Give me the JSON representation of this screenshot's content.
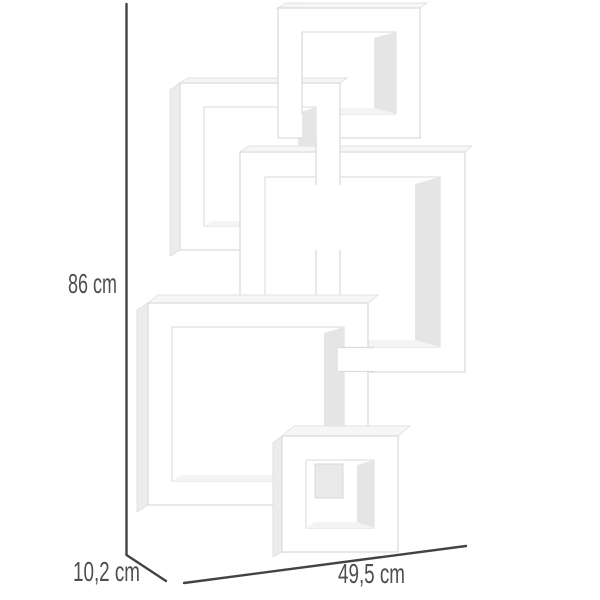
{
  "product_image": {
    "kind": "interlocking cube wall shelf, white, five cubes, diagonal arrangement",
    "cube_count": 5
  },
  "dimensions": {
    "height": "86 cm",
    "depth": "10,2 cm",
    "width": "49,5 cm"
  },
  "colors": {
    "background": "#ffffff",
    "dimension_line": "#434343",
    "label_text": "#4f4f4f",
    "shelf_white": "#ffffff",
    "shelf_edge": "#dcdcdc",
    "shelf_inner_shadow": "#e5e5e5"
  }
}
